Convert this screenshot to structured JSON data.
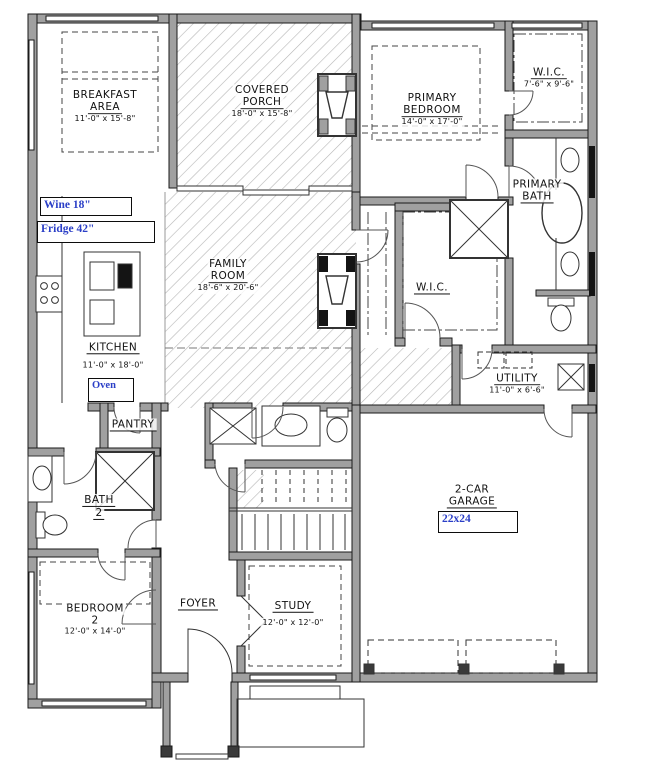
{
  "meta": {
    "drawing_type": "residential floor plan",
    "wall_color": "#a0a0a0",
    "line_color": "#1a1a1a",
    "annotation_color": "#2b3fc7",
    "hatch_color": "#b5b5b5"
  },
  "rooms": {
    "breakfast": {
      "line1": "BREAKFAST",
      "line2": "AREA",
      "dims": "11'-0\" x 15'-8\""
    },
    "covered_porch": {
      "line1": "COVERED",
      "line2": "PORCH",
      "dims": "18'-0\" x 15'-8\""
    },
    "primary_bedroom": {
      "line1": "PRIMARY",
      "line2": "BEDROOM",
      "dims": "14'-0\" x 17'-0\""
    },
    "wic_primary": {
      "line1": "W.I.C.",
      "dims": "7'-6\" x 9'-6\""
    },
    "primary_bath": {
      "line1": "PRIMARY",
      "line2": "BATH"
    },
    "family_room": {
      "line1": "FAMILY",
      "line2": "ROOM",
      "dims": "18'-6\" x 20'-6\""
    },
    "kitchen": {
      "line1": "KITCHEN",
      "dims": "11'-0\" x 18'-0\""
    },
    "wic2": {
      "line1": "W.I.C."
    },
    "utility": {
      "line1": "UTILITY",
      "dims": "11'-0\" x 6'-6\""
    },
    "pantry": {
      "line1": "PANTRY"
    },
    "bath2": {
      "line1": "BATH",
      "line2": "2"
    },
    "bedroom2": {
      "line1": "BEDROOM",
      "line2": "2",
      "dims": "12'-0\" x 14'-0\""
    },
    "foyer": {
      "line1": "FOYER"
    },
    "study": {
      "line1": "STUDY",
      "dims": "12'-0\" x 12'-0\""
    },
    "garage": {
      "line1": "2-CAR",
      "line2": "GARAGE"
    }
  },
  "annotations": {
    "wine": "Wine 18\"",
    "fridge": "Fridge 42\"",
    "oven": "Oven",
    "garage_size": "22x24"
  }
}
